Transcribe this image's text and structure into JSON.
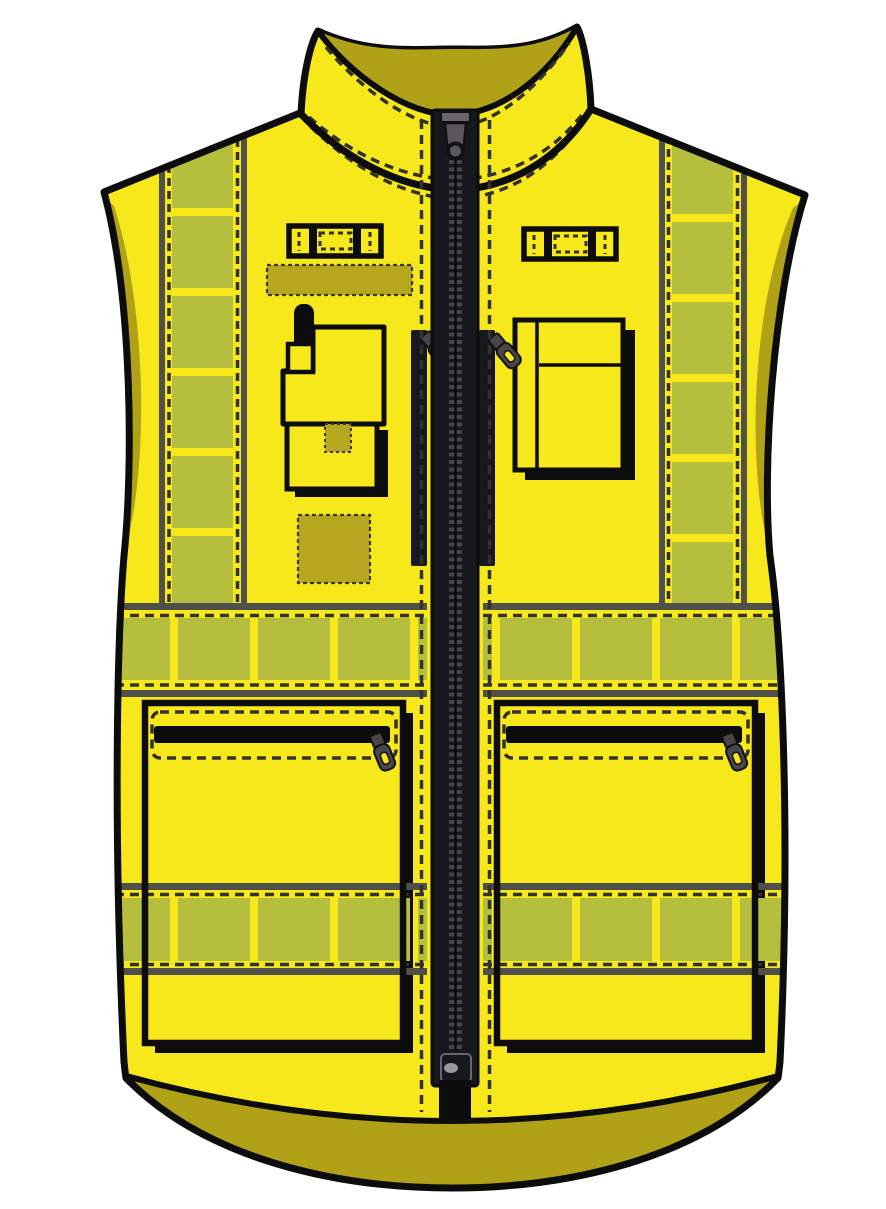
{
  "title": "High-visibility safety vest — technical front-view flat illustration",
  "garment": {
    "type": "hi-vis zip vest (gilet)",
    "view": "front",
    "parts": [
      "stand-up collar with topstitching",
      "full-length front zipper with slider and bottom stop",
      "left shoulder vertical reflective band",
      "right shoulder vertical reflective band",
      "chest horizontal reflective band",
      "waist horizontal reflective band",
      "left mic / loop tab",
      "right mic / loop tab",
      "id badge strip patch",
      "radio pocket with antenna",
      "small hook-and-loop square patch",
      "document pocket with pen slot",
      "left vertical chest zip",
      "right vertical chest zip",
      "left lower zip pocket",
      "right lower zip pocket",
      "contrast hem band"
    ]
  },
  "colors": {
    "vest_yellow": "#f6e81a",
    "band_green": "#b5bf3d",
    "shade_olive": "#b1a117",
    "patch_olive": "#b7a71e",
    "stripe_grey": "#50504a",
    "stitch_dark": "#32322d",
    "zipper_dark": "#17171e",
    "teeth_grey": "#44444e",
    "pull_grey": "#4a4647",
    "outline_black": "#0c0c0c",
    "background": "#ffffff"
  }
}
